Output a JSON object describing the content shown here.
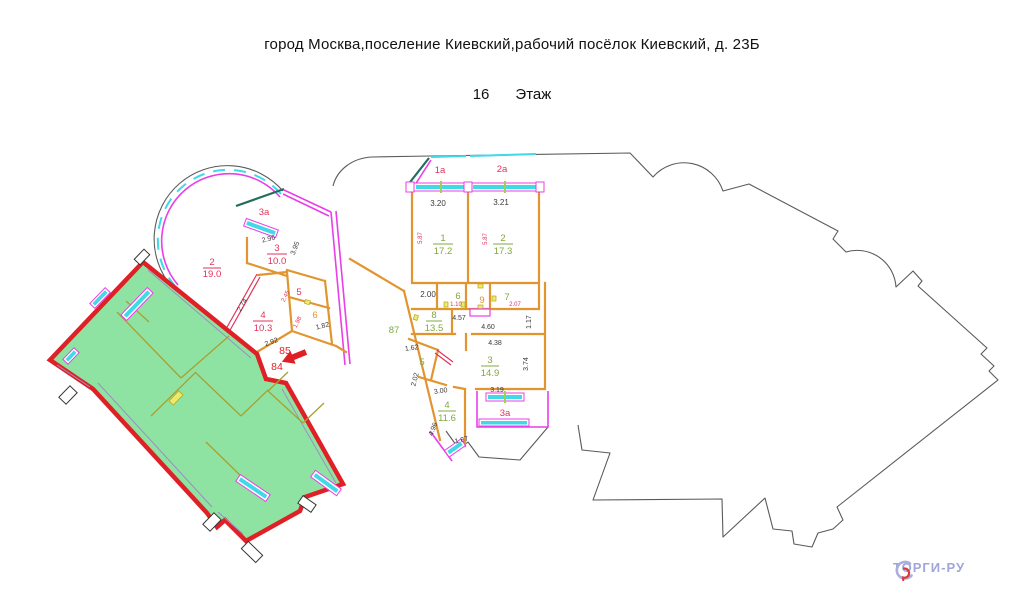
{
  "header": {
    "address": "город Москва,поселение Киевский,рабочий посёлок Киевский, д. 23Б",
    "floor_number": "16",
    "floor_word": "Этаж"
  },
  "watermark": {
    "brand": "ТОРГИ-РУ"
  },
  "apartments": {
    "left": {
      "balcony": "3a",
      "r2": {
        "n": "2",
        "a": "19.0"
      },
      "r3": {
        "n": "3",
        "a": "10.0"
      },
      "r4": {
        "n": "4",
        "a": "10.3"
      },
      "r5": "5",
      "r6": "6"
    },
    "middle": {
      "b1a": "1a",
      "b2a": "2a",
      "b3a": "3a",
      "r1": {
        "n": "1",
        "a": "17.2"
      },
      "r2": {
        "n": "2",
        "a": "17.3"
      },
      "r3": {
        "n": "3",
        "a": "14.9"
      },
      "r4": {
        "n": "4",
        "a": "11.6"
      },
      "r5": "5",
      "r6": "6",
      "r7": "7",
      "r8": {
        "n": "8",
        "a": "13.5"
      },
      "r9": "9"
    },
    "corridor": "87",
    "highlight": {
      "n85": "85",
      "n84": "84"
    }
  },
  "dims": {
    "d296": "2.96",
    "d395": "3.95",
    "d274": "2.74",
    "d245": "2.45",
    "d198": "1.98",
    "d182": "1.82",
    "d292": "2.92",
    "d320": "3.20",
    "d321": "3.21",
    "d587": "5.87",
    "d200": "2.00",
    "d110": "1.10",
    "d207": "2.07",
    "d457": "4.57",
    "d460": "4.60",
    "d117": "1.17",
    "d438": "4.38",
    "d374": "3.74",
    "d162": "1.62",
    "d202": "2.02",
    "d300": "3.00",
    "d496": "4.96",
    "d187": "1.87",
    "d319": "3.19"
  },
  "colors": {
    "highlight_fill": "#8fe3a2",
    "highlight_border": "#df2026",
    "wall_orange": "#e2952f",
    "wall_magenta": "#e93ee9",
    "window_cyan": "#3fd9e8",
    "label_green": "#7fa83c",
    "label_red": "#e0335c",
    "arrow_red": "#e01f25",
    "outline": "#5a5a5a",
    "watermark_text": "#a0a5db"
  }
}
